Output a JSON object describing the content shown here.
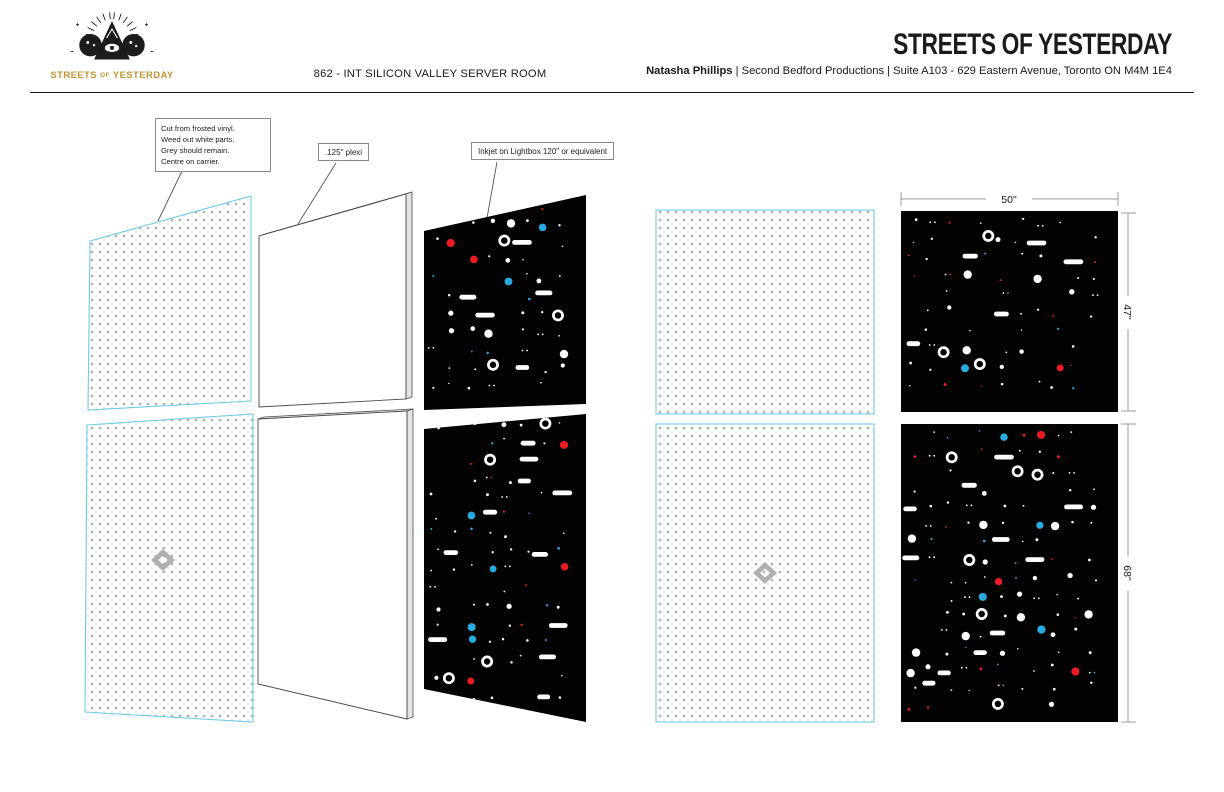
{
  "header": {
    "logo": {
      "line1": "STREETS",
      "line2": "OF",
      "line3": "YESTERDAY"
    },
    "scene_title": "862 - INT SILICON VALLEY SERVER ROOM",
    "production_title": "STREETS OF YESTERDAY",
    "contact": {
      "name": "Natasha Phillips",
      "details": "| Second Bedford Productions | Suite A103 - 629 Eastern Avenue, Toronto ON M4M 1E4"
    }
  },
  "callouts": {
    "vinyl": {
      "lines": [
        "Cut from frosted vinyl.",
        "Weed out white parts.",
        "Grey should remain.",
        "Centre on carrier."
      ]
    },
    "plexi": {
      "label": ".125\" plexi"
    },
    "inkjet": {
      "label": "Inkjet on Lightbox 120\" or equivalent"
    }
  },
  "dimensions": {
    "width_top": "50\"",
    "height_top": "47\"",
    "height_bottom": "68\""
  },
  "colors": {
    "logo_gold": "#c49435",
    "vinyl_outline": "#6ec9ea",
    "dot_grey": "#b4b4b4",
    "dot_grey_small": "#c6c6c6",
    "panel_black": "#030303",
    "light_white": "#ffffff",
    "light_red": "#ed1c24",
    "light_blue": "#29abe2",
    "dim_line": "#9b9b9b"
  },
  "light_panels": [
    {
      "name": "exploded-top-lightbox",
      "seed": 101,
      "x": 424,
      "y": 195,
      "w": 162,
      "h": 215
    },
    {
      "name": "exploded-bottom-lightbox",
      "seed": 207,
      "x": 424,
      "y": 414,
      "w": 162,
      "h": 308
    },
    {
      "name": "flat-top-lightbox",
      "seed": 313,
      "x": 901,
      "y": 211,
      "w": 217,
      "h": 201
    },
    {
      "name": "flat-bottom-lightbox",
      "seed": 420,
      "x": 901,
      "y": 424,
      "w": 217,
      "h": 298
    }
  ],
  "lights_config": {
    "cell": 18,
    "margin": 11
  }
}
